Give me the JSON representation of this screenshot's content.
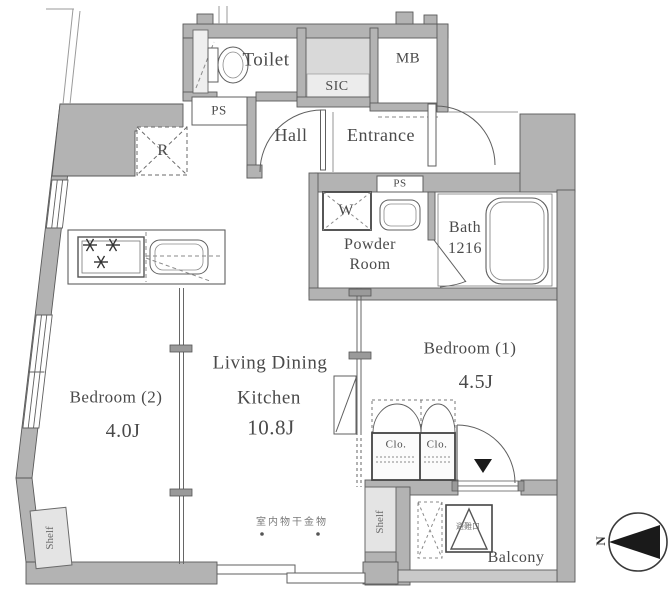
{
  "rooms": {
    "toilet": {
      "label": "Toilet"
    },
    "sic": {
      "label": "SIC"
    },
    "mb": {
      "label": "MB"
    },
    "hall": {
      "label": "Hall"
    },
    "entrance": {
      "label": "Entrance"
    },
    "powder": {
      "line1": "Powder",
      "line2": "Room"
    },
    "bath": {
      "line1": "Bath",
      "line2": "1216"
    },
    "bedroom1": {
      "label": "Bedroom (1)",
      "area": "4.5J"
    },
    "ldk": {
      "line1": "Living Dining",
      "line2": "Kitchen",
      "area": "10.8J"
    },
    "bedroom2": {
      "label": "Bedroom (2)",
      "area": "4.0J"
    },
    "balcony": {
      "label": "Balcony"
    }
  },
  "fixtures": {
    "ps_upper": "PS",
    "ps_lower": "PS",
    "refrigerator": "R",
    "washer": "W",
    "closet1": "Clo.",
    "closet2": "Clo.",
    "shelf_left": "Shelf",
    "shelf_right": "Shelf"
  },
  "annotations": {
    "indoor_drying": "室内物干金物",
    "evacuation_hatch": "避難口",
    "compass_north": "N"
  },
  "colors": {
    "wall": "#b3b3b3",
    "wall_line": "#5a5a5a",
    "ink": "#4a4a4a",
    "shade": "#d9d9d9",
    "shade_band": "#ececec",
    "shelf": "#e4e4e4",
    "rail": "#c9c9c9",
    "black": "#1a1a1a"
  }
}
